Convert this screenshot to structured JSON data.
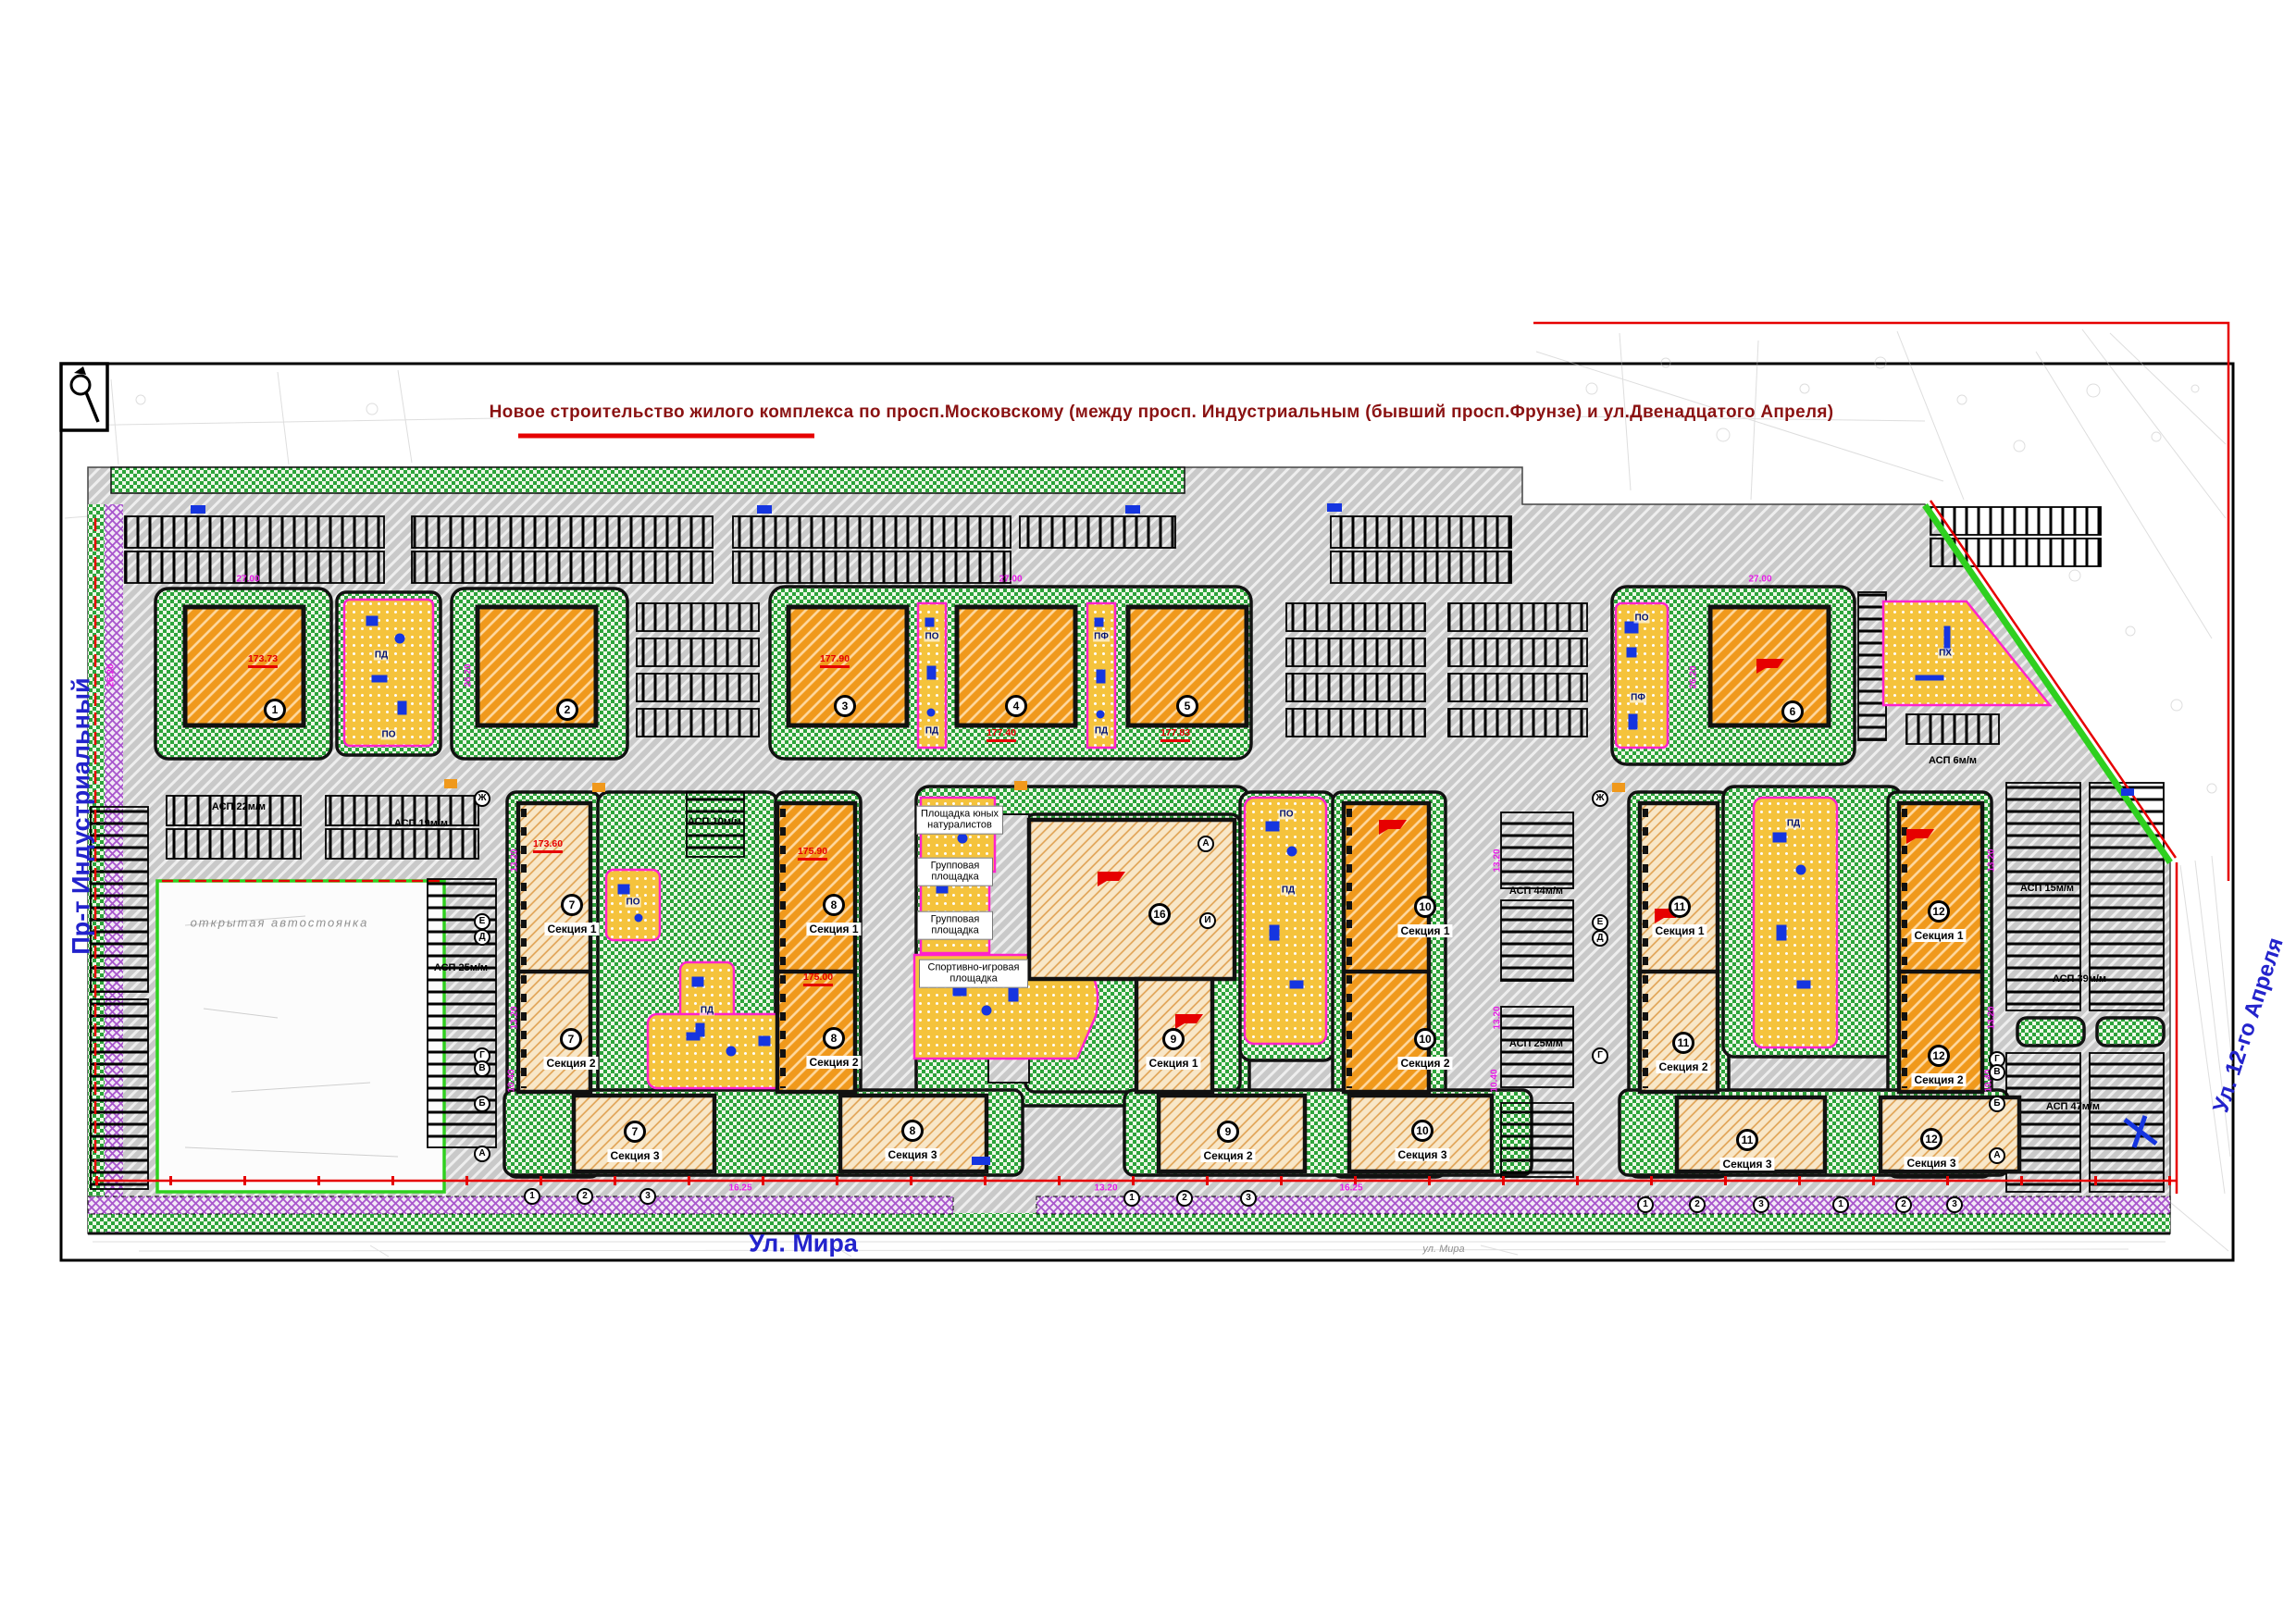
{
  "page": {
    "title": "Новое строительство жилого комплекса по просп.Московскому (между просп. Индустриальным (бывший просп.Фрунзе)   и ул.Двенадцатого Апреля)"
  },
  "streets": {
    "left": "Пр-т Индустриальный",
    "bottom": "Ул. Мира",
    "bottom_survey": "ул. Мира",
    "right": "Ул. 12-го Апреля"
  },
  "buildings": {
    "b1": "1",
    "b2": "2",
    "b3": "3",
    "b4": "4",
    "b5": "5",
    "b6": "6",
    "b7": "7",
    "b8": "8",
    "b9": "9",
    "b10": "10",
    "b11": "11",
    "b12": "12",
    "b16": "16"
  },
  "labels": {
    "sec1": "Секция 1",
    "sec2": "Секция 2",
    "sec3": "Секция 3",
    "pd": "ПД",
    "po": "ПО",
    "pf": "ПФ",
    "ph": "ПХ",
    "pg_naturalists": "Площадка юных натуралистов",
    "pg_group": "Групповая площадка",
    "pg_sport": "Спортивно-игровая площадка",
    "open_parking": "открытая автостоянка"
  },
  "parking": {
    "a22": "АСП 22м/м",
    "a19": "АСП 19м/м",
    "a25": "АСП 25м/м",
    "a10": "АСП 10м/м",
    "a44": "АСП 44м/м",
    "a25b": "АСП 25м/м",
    "a15": "АСП 15м/м",
    "a39": "АСП 39м/м",
    "a47": "АСП 47м/м",
    "a6": "АСП 6м/м"
  },
  "dimensions": {
    "d2700": "27.00",
    "d2620": "26.20",
    "d1320": "13.20",
    "d1040": "10.40",
    "d1625": "16.25"
  },
  "elevations": {
    "e1": "173.73",
    "e3": "177.90",
    "e4": "177.40",
    "e5": "177.83",
    "e8a": "175.90",
    "e8b": "175.00",
    "e7": "173.60"
  },
  "axes": {
    "zh": "Ж",
    "e": "Е",
    "d": "Д",
    "g": "Г",
    "v": "В",
    "b": "Б",
    "a": "А",
    "i": "И",
    "n1": "1",
    "n2": "2",
    "n3": "3"
  },
  "colors": {
    "asphalt": "#c9c9c9",
    "green": "#2ca43a",
    "tower_orange": "#f0991c",
    "slab_beige": "#f8e7c8",
    "playground_yellow": "#f5c33c",
    "sport_purple": "#a855cc",
    "boundary_red": "#e60000",
    "street_blue": "#2323cc",
    "title_maroon": "#8a1212",
    "magenta_border": "#ff22cc",
    "equipment_blue": "#1535e0"
  }
}
